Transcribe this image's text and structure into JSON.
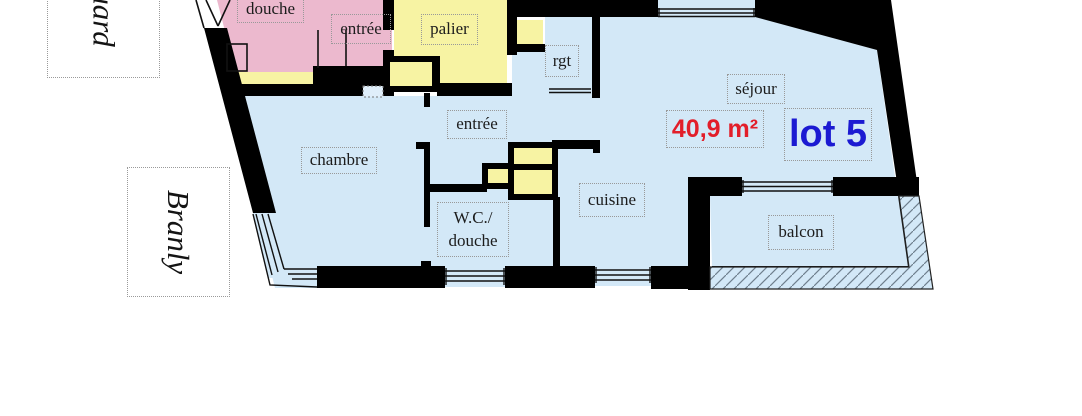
{
  "streets": {
    "edouard": "uard",
    "branly": "Branly"
  },
  "rooms": {
    "douche": "douche",
    "entree_voisin": "entrée",
    "palier": "palier",
    "rgt": "rgt",
    "sejour": "séjour",
    "chambre": "chambre",
    "entree": "entrée",
    "wc_douche": "W.C./\ndouche",
    "cuisine": "cuisine",
    "balcon": "balcon"
  },
  "lot": {
    "name": "lot 5",
    "area": "40,9 m²"
  },
  "colors": {
    "lot_fill": "#d3e8f7",
    "neighbor_fill": "#ecb9ce",
    "common_fill": "#f7f3a3",
    "wall": "#000000",
    "lot_name_color": "#1b1ad2",
    "area_color": "#e21e2a",
    "hatch_line": "#6e7f8d",
    "label_border": "#999999",
    "label_text": "#1c1c1c"
  }
}
